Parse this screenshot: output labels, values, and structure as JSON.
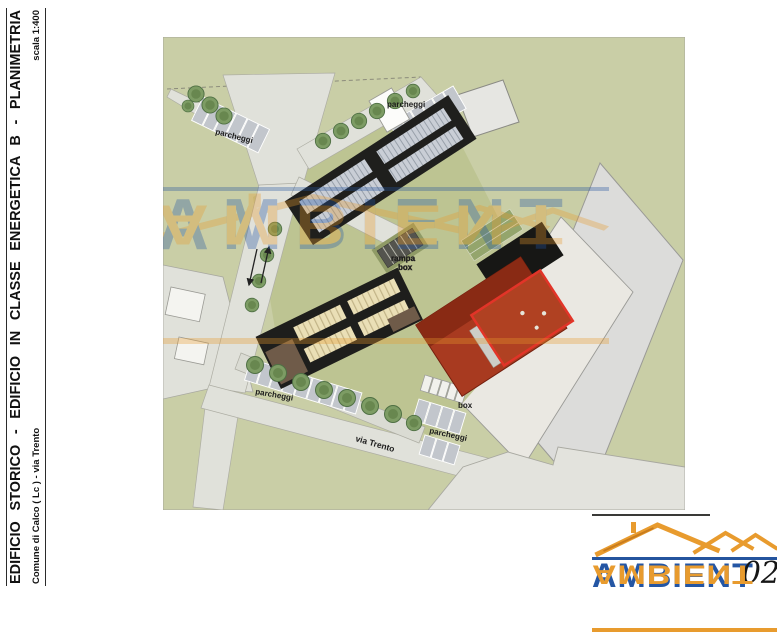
{
  "title_block": {
    "title": "EDIFICIO STORICO - EDIFICIO IN CLASSE ENERGETICA B - PLANIMETRIA",
    "subtitle": "Comune di Calco ( Lc ) - via Trento",
    "scale": "scala 1:400"
  },
  "plan": {
    "labels": {
      "parcheggi_topleft": "parcheggi",
      "parcheggi_top": "parcheggi",
      "parcheggi_bottom": "parcheggi",
      "parcheggi_right": "parcheggi",
      "box": "box",
      "rampa_line1": "rampa",
      "rampa_line2": "box",
      "street": "via Trento"
    },
    "colors": {
      "ground": "#c9cea6",
      "road": "#e0e1da",
      "parking_stall": "#c2c6cc",
      "roof_dark": "#1e1e1c",
      "panel_gray": "#c9ced6",
      "panel_tan": "#eadfb6",
      "brown": "#6f5b49",
      "red_building": "#a83a20",
      "red_outline": "#e23428",
      "tree_green": "#7d9c64",
      "paved_gray": "#e3e3dd"
    }
  },
  "watermark": {
    "text": "AMBIENT"
  },
  "logo": {
    "text": "AMBIENT",
    "number": "02",
    "blue": "#2456a4",
    "orange": "#e89b2e"
  }
}
